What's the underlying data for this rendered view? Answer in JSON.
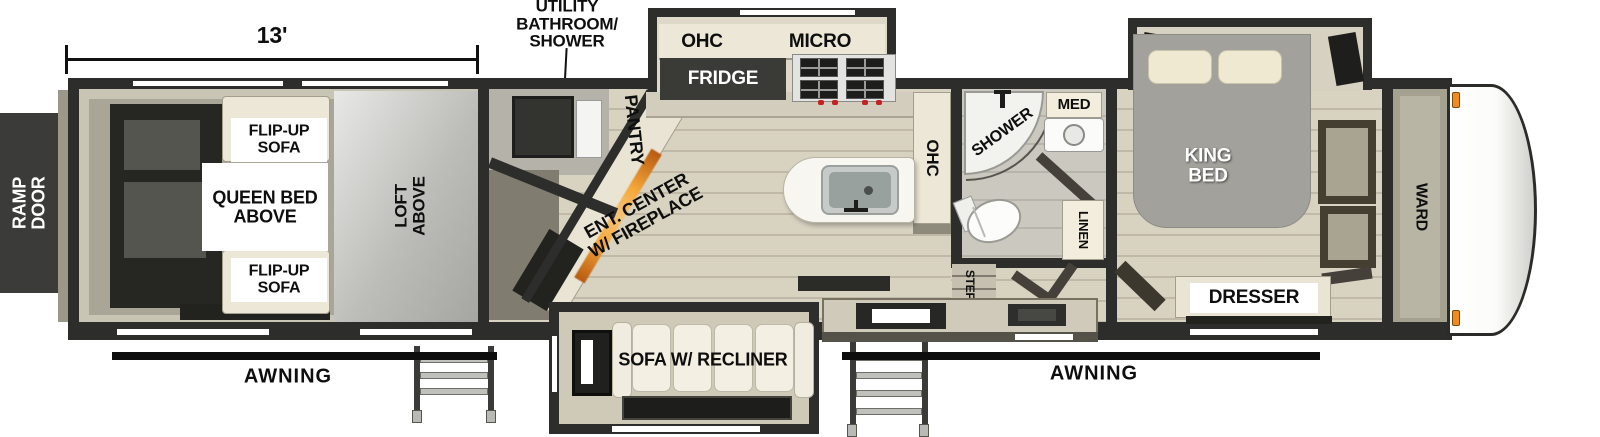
{
  "fp": {
    "type": "toy-hauler travel trailer floorplan",
    "dim": "13'",
    "callout_utility": "UTILITY\nBATHROOM/\nSHOWER",
    "ramp_door": "RAMP\nDOOR",
    "awning_rear": "AWNING",
    "awning_front": "AWNING",
    "garage": {
      "flip_top": "FLIP-UP\nSOFA",
      "queen": "QUEEN BED\nABOVE",
      "flip_bottom": "FLIP-UP\nSOFA",
      "loft": "LOFT\nABOVE"
    },
    "kitchen": {
      "pantry": "PANTRY",
      "ohc": "OHC",
      "micro": "MICRO",
      "fridge": "FRIDGE",
      "ent": "ENT. CENTER\nW/ FIREPLACE",
      "ohc_tall": "OHC"
    },
    "living": {
      "sofa": "SOFA W/ RECLINER"
    },
    "bath": {
      "shower": "SHOWER",
      "med": "MED",
      "linen": "LINEN",
      "steps": "STEPS"
    },
    "bed": {
      "king": "KING\nBED",
      "dresser": "DRESSER",
      "ward": "WARD"
    },
    "colors": {
      "wall": "#2d2d2b",
      "cabinet_cream": "#ece7d7",
      "fireplace_accent": "#f6a93c",
      "marker_light": "#ef8b1f",
      "awning": "#0d0d0d"
    }
  }
}
